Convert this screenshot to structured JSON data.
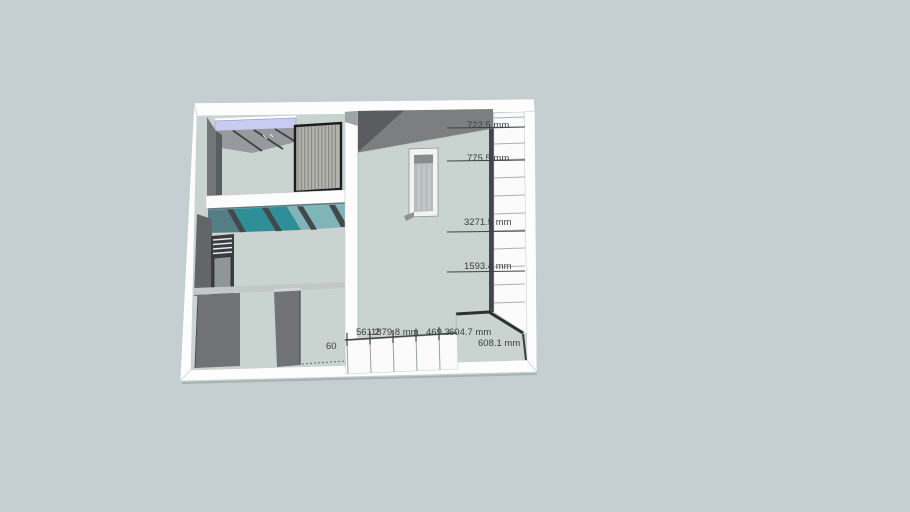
{
  "scene": {
    "type": "3d-model-viewport",
    "description": "Architectural house model with staircases and dimension annotations",
    "background_color": "#c5cfd1",
    "unit": "mm",
    "colors": {
      "floor": "#c9d3cf",
      "outer_wall": "#fcfcfd",
      "wall_face": "#717476",
      "wall_top": "#7c7e80",
      "glass_teal": "#2f8f99",
      "ceiling_lavender": "#c9cbf2",
      "stair_hatch": "#b3b3ae",
      "dimension_text": "#3b3e3e"
    },
    "dimension_labels": [
      {
        "id": "dim-722-5",
        "text": "722.5 mm",
        "x": 467,
        "y": 121
      },
      {
        "id": "dim-775-5",
        "text": "775.5 mm",
        "x": 467,
        "y": 154
      },
      {
        "id": "dim-3271-5",
        "text": "3271.5 mm",
        "x": 464,
        "y": 218
      },
      {
        "id": "dim-1593-4",
        "text": "1593.4 mm",
        "x": 464,
        "y": 262
      },
      {
        "id": "dim-561-2",
        "text": "561.2",
        "x": 356,
        "y": 328
      },
      {
        "id": "dim-1879-8",
        "text": "1879.8 mm",
        "x": 371,
        "y": 328
      },
      {
        "id": "dim-469-3",
        "text": "469.3",
        "x": 426,
        "y": 328
      },
      {
        "id": "dim-604-7",
        "text": "604.7 mm",
        "x": 449,
        "y": 328
      },
      {
        "id": "dim-608-1",
        "text": "608.1 mm",
        "x": 478,
        "y": 339
      },
      {
        "id": "dim-partial-60",
        "text": "60",
        "x": 326,
        "y": 342
      }
    ]
  }
}
